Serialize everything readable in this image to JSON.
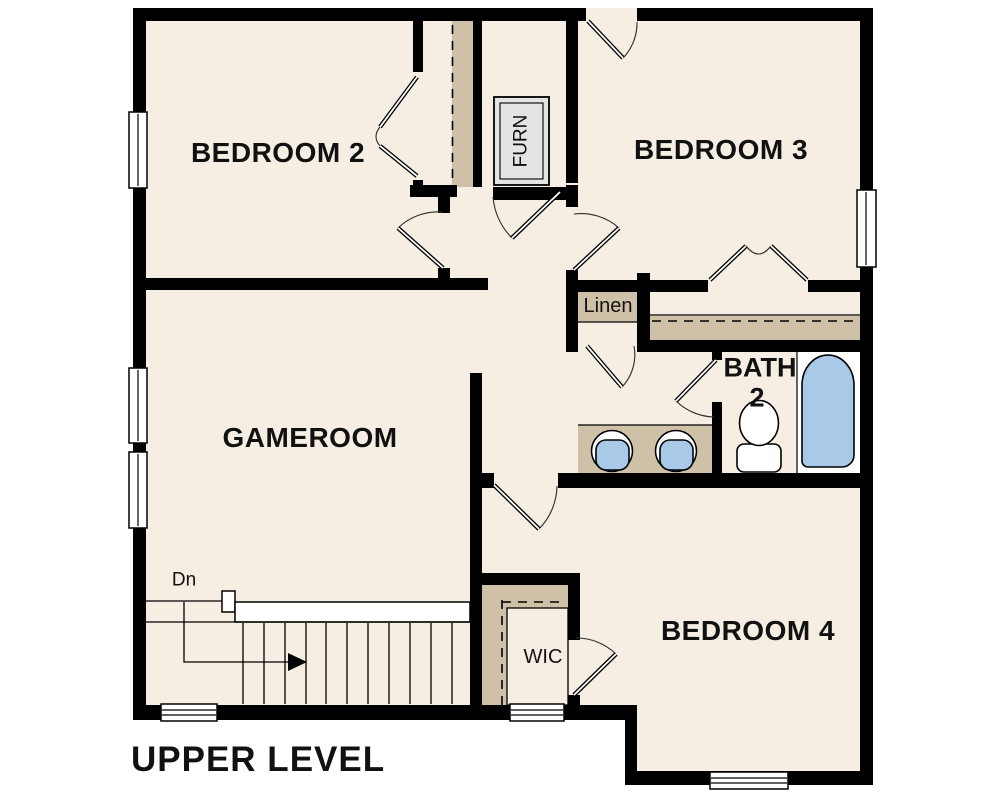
{
  "title": "UPPER LEVEL",
  "labels": {
    "bedroom2": "BEDROOM 2",
    "bedroom3": "BEDROOM 3",
    "gameroom": "GAMEROOM",
    "bedroom4": "BEDROOM 4",
    "bath_line1": "BATH",
    "bath_line2": "2",
    "linen": "Linen",
    "wic": "WIC",
    "furnace": "FURN",
    "stairs_down": "Dn"
  },
  "colors": {
    "floor": "#f6eee2",
    "closet_shelf": "#cfc1a7",
    "wall": "#000000",
    "window": "#ffffff",
    "fixture_blue": "#a9c9e9",
    "furnace_gray": "#e2e5e1",
    "label_text": "#111111"
  }
}
